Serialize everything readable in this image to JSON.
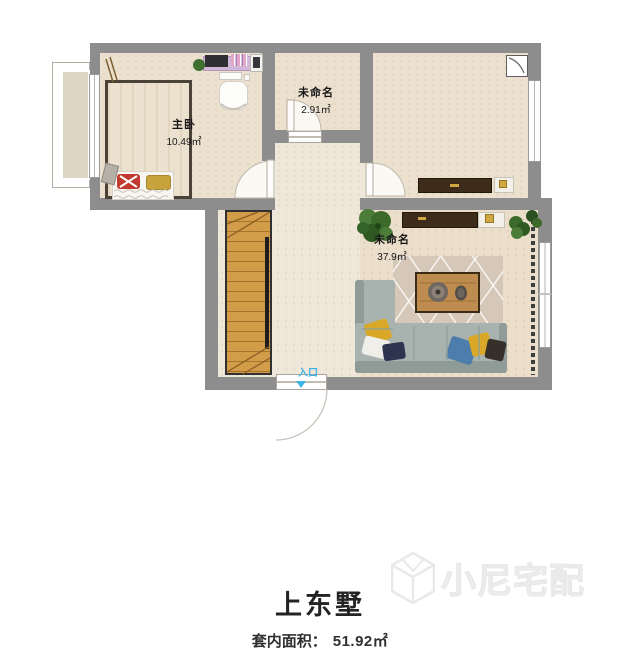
{
  "plan": {
    "rooms": {
      "master": {
        "name": "主卧",
        "area": "10.49㎡"
      },
      "small": {
        "name": "未命名",
        "area": "2.91㎡"
      },
      "living": {
        "name": "未命名",
        "area": "37.9㎡"
      }
    },
    "entrance_label": "入口"
  },
  "footer": {
    "title": "上东墅",
    "area_label": "套内面积：",
    "area_value": "51.92㎡"
  },
  "watermark": {
    "brand": "小尼宅配"
  },
  "colors": {
    "wall": "#8d8d8d",
    "floor": "#ece1cf",
    "hall_floor": "#efe8da",
    "living_floor": "#ebdecb",
    "stair_wood": "#d29c49",
    "sofa": "#a8b2ae",
    "entrance_accent": "#3fb3e6",
    "furniture_dark": "#3e2c1b",
    "gold_accent": "#cfa743"
  }
}
